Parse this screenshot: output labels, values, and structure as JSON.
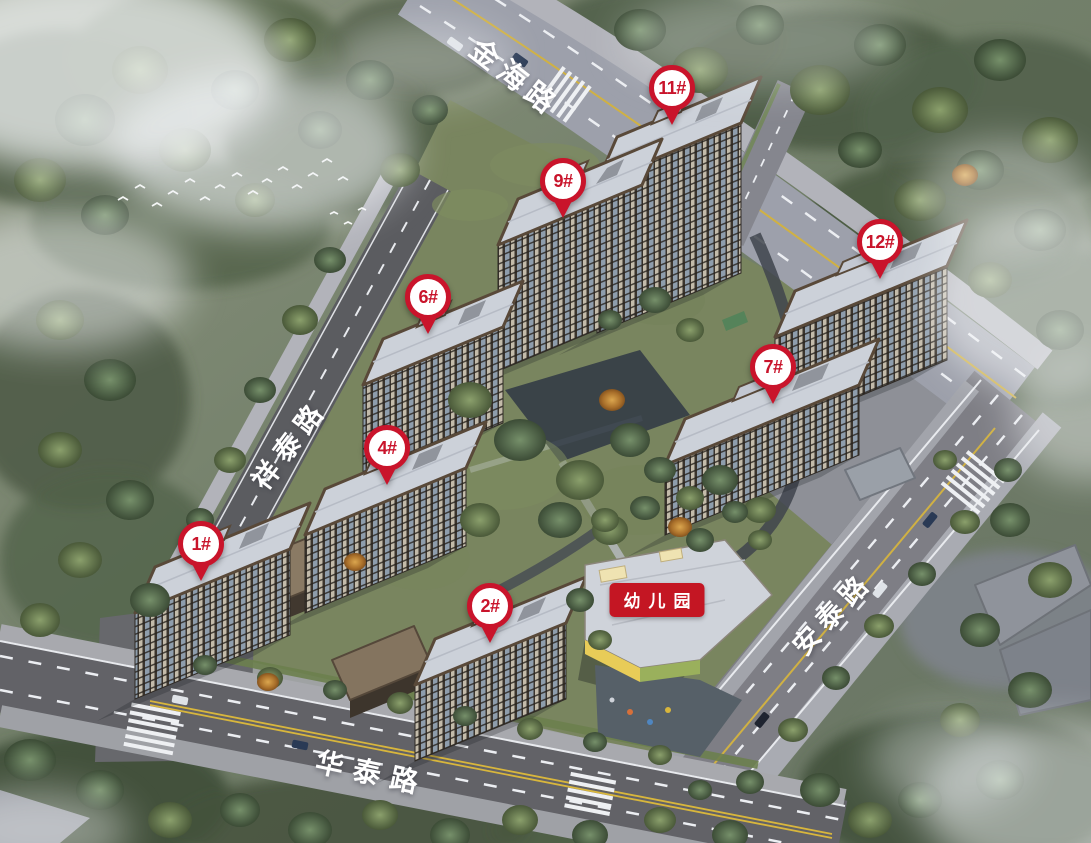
{
  "scene_type": "residential-development-aerial-rendering",
  "markers": [
    {
      "label": "1#",
      "icon": "map-pin"
    },
    {
      "label": "2#",
      "icon": "map-pin"
    },
    {
      "label": "4#",
      "icon": "map-pin"
    },
    {
      "label": "6#",
      "icon": "map-pin"
    },
    {
      "label": "7#",
      "icon": "map-pin"
    },
    {
      "label": "9#",
      "icon": "map-pin"
    },
    {
      "label": "11#",
      "icon": "map-pin"
    },
    {
      "label": "12#",
      "icon": "map-pin"
    }
  ],
  "road_labels": {
    "north": "金海路",
    "west": "祥泰路",
    "east": "安泰路",
    "south": "华泰路"
  },
  "facility_labels": {
    "kindergarten": "幼儿园"
  },
  "colors": {
    "marker_red": "#c9142b",
    "badge_red": "#c41623",
    "label_white": "#ffffff"
  }
}
